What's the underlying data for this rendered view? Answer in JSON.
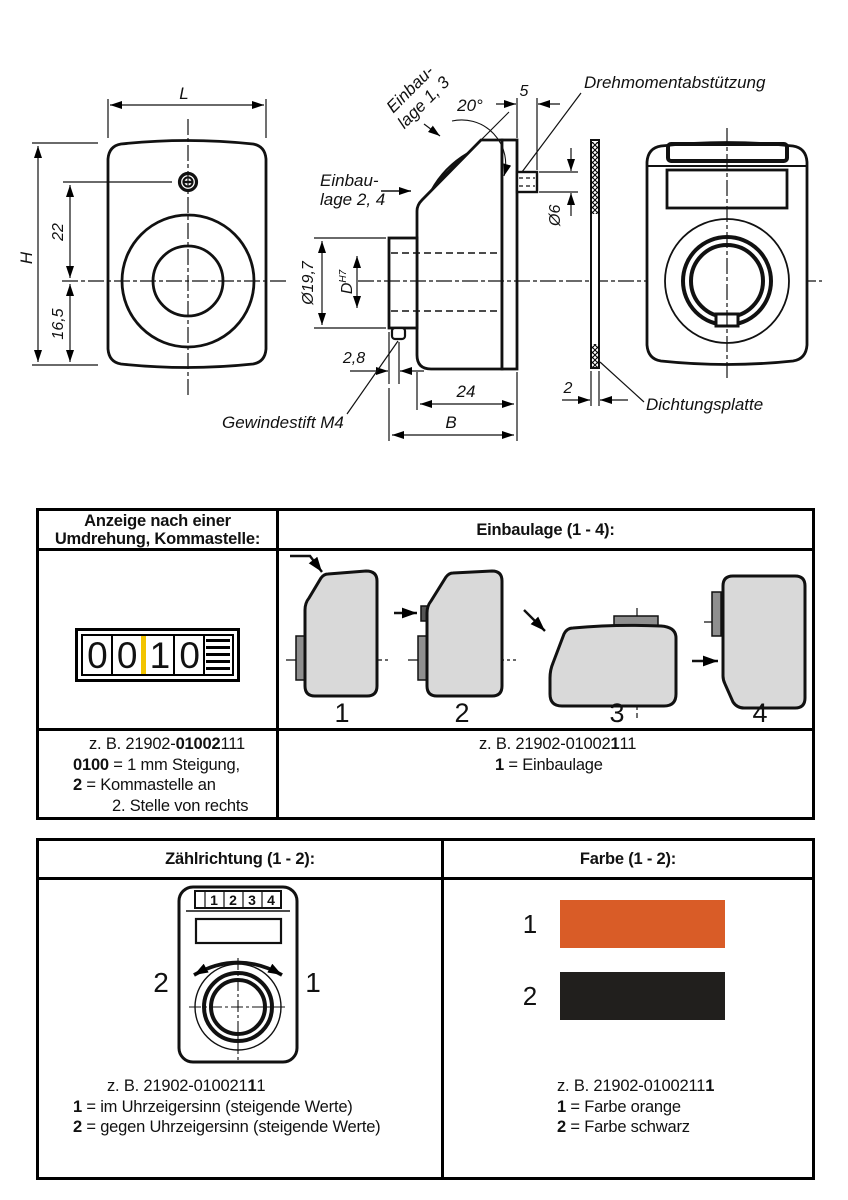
{
  "drawing": {
    "labels": {
      "L": "L",
      "H": "H",
      "dim22": "22",
      "dim165": "16,5",
      "einbaulage13_l1": "Einbau-",
      "einbaulage13_l2": "lage 1, 3",
      "einbaulage24_l1": "Einbau-",
      "einbaulage24_l2": "lage 2, 4",
      "angle": "20°",
      "dim5": "5",
      "drehmoment": "Drehmomentabstützung",
      "dia6": "Ø6",
      "dia197": "Ø19,7",
      "boreD": "D",
      "boreTol": "H7",
      "dim28": "2,8",
      "dim24": "24",
      "B": "B",
      "gewindestift": "Gewindestift M4",
      "dim2": "2",
      "dichtungsplatte": "Dichtungsplatte"
    }
  },
  "table1": {
    "header_left_l1": "Anzeige nach einer",
    "header_left_l2": "Umdrehung, Kommastelle:",
    "header_right": "Einbaulage (1 - 4):",
    "counter": {
      "digits": [
        "0",
        "0",
        "1",
        "0"
      ],
      "marker_color": "#f2c400"
    },
    "positions": [
      "1",
      "2",
      "3",
      "4"
    ],
    "footer_left": {
      "l1_pre": "z. B.  21902-",
      "l1_bold": "01002",
      "l1_post": "111",
      "l2_bold": "0100",
      "l2_post": " = 1 mm Steigung,",
      "l3_bold": "2",
      "l3_post": " = Kommastelle an",
      "l4": "2. Stelle von rechts"
    },
    "footer_right": {
      "l1_pre": "z. B. 21902-01002",
      "l1_bold": "1",
      "l1_post": "11",
      "l2_bold": "1",
      "l2_post": " = Einbaulage"
    }
  },
  "table2": {
    "header_left": "Zählrichtung (1 - 2):",
    "header_right": "Farbe (1 - 2):",
    "device": {
      "counter_digits": [
        "1",
        "2",
        "3",
        "4"
      ],
      "left_num": "2",
      "right_num": "1"
    },
    "colors": [
      {
        "num": "1",
        "hex": "#d95c27"
      },
      {
        "num": "2",
        "hex": "#211f1d"
      }
    ],
    "footer_left": {
      "l1_pre": "z. B.  21902-010021",
      "l1_bold": "1",
      "l1_post": "1",
      "l2_bold": "1",
      "l2_post": " = im Uhrzeigersinn (steigende Werte)",
      "l3_bold": "2",
      "l3_post": " = gegen Uhrzeigersinn (steigende Werte)"
    },
    "footer_right": {
      "l1_pre": "z. B. 21902-0100211",
      "l1_bold": "1",
      "l1_post": "",
      "l2_bold": "1",
      "l2_post": " = Farbe orange",
      "l3_bold": "2",
      "l3_post": " = Farbe schwarz"
    }
  }
}
